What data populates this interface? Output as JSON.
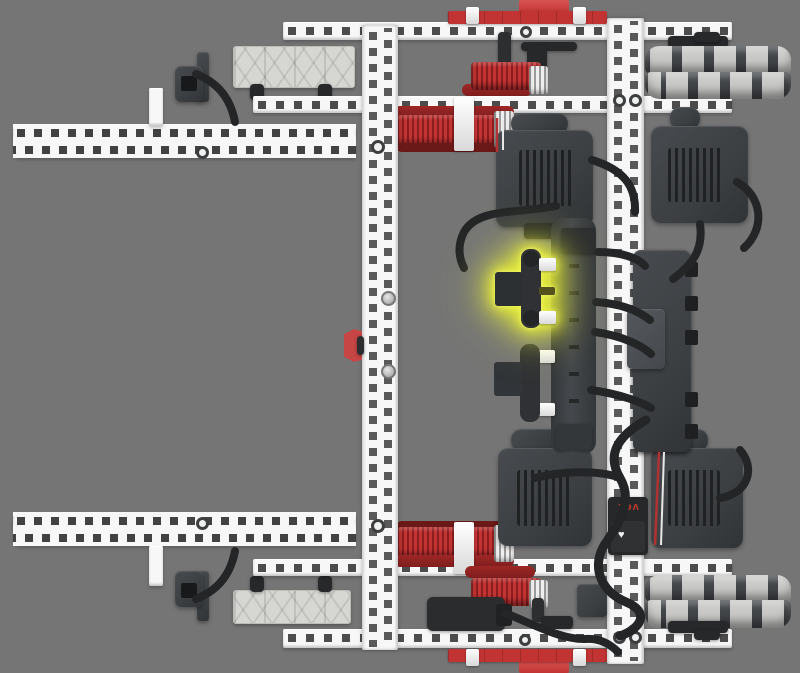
{
  "scene": {
    "highlight_color": "#e8ef3f"
  },
  "radio": {
    "brand_label": "vex",
    "heart_icon": "♥"
  },
  "colors": {
    "bg": "#757575",
    "beam": "#f7f7f7",
    "hole": "#4c4c4c",
    "holec": "#595959",
    "red": "#c23434",
    "red-dark": "#7f1e1e",
    "red-mid": "#9e2626",
    "metal": "#3c3f42",
    "metal-dark": "#26282a",
    "cable": "#232527",
    "roller": "#c9c9c7",
    "hub": "#424548",
    "plate": "#d6d6d3",
    "highlight": "#e8ef3f",
    "wire-red": "#b03232",
    "wire-white": "#e8e8e8"
  }
}
